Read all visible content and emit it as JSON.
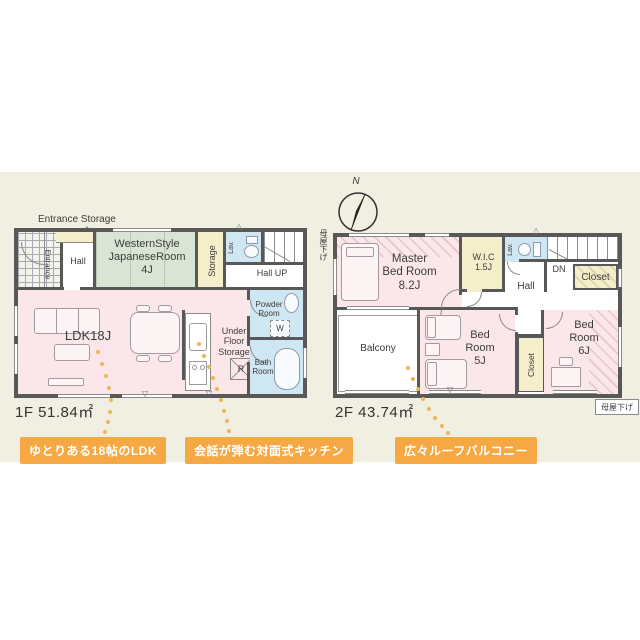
{
  "floor1": {
    "area_label": "1F 51.84㎡",
    "entrance_storage_label": "Entrance Storage",
    "entrance": "Entrance",
    "hall": "Hall",
    "jroom_l1": "WesternStyle",
    "jroom_l2": "JapaneseRoom",
    "jroom_l3": "4J",
    "storage": "Storage",
    "lav": "Lav.",
    "hall_up": "Hall UP",
    "ldk": "LDK18J",
    "under_floor_l1": "Under",
    "under_floor_l2": "Floor",
    "under_floor_l3": "Storage",
    "fridge": "R",
    "washer": "W",
    "powder_l1": "Powder",
    "powder_l2": "Room",
    "bath_l1": "Bath",
    "bath_l2": "Room"
  },
  "floor2": {
    "area_label": "2F 43.74㎡",
    "north": "N",
    "master_l1": "Master",
    "master_l2": "Bed Room",
    "master_l3": "8.2J",
    "wic_l1": "W.I.C",
    "wic_l2": "1.5J",
    "lav": "Lav.",
    "dn": "DN",
    "closet_upper": "Closet",
    "hall": "Hall",
    "balcony": "Balcony",
    "bedroom5_l1": "Bed",
    "bedroom5_l2": "Room",
    "bedroom5_l3": "5J",
    "closet_lower": "Closet",
    "bedroom6_l1": "Bed",
    "bedroom6_l2": "Room",
    "bedroom6_l3": "6J",
    "moya_sage_left": "母屋下げ",
    "moya_sage_right": "母屋下げ"
  },
  "annotations": {
    "ldk": "ゆとりある18帖のLDK",
    "kitchen": "会話が弾む対面式キッチン",
    "balcony": "広々ルーフバルコニー"
  },
  "colors": {
    "background_band": "#f0efe2",
    "wall": "#585858",
    "room_pink": "#fbe7ea",
    "room_green": "#d9e4d4",
    "room_yellow": "#f5eecb",
    "room_blue": "#cfe7f2",
    "annotation_orange": "#f5a843",
    "dot_orange": "#e9b757"
  }
}
